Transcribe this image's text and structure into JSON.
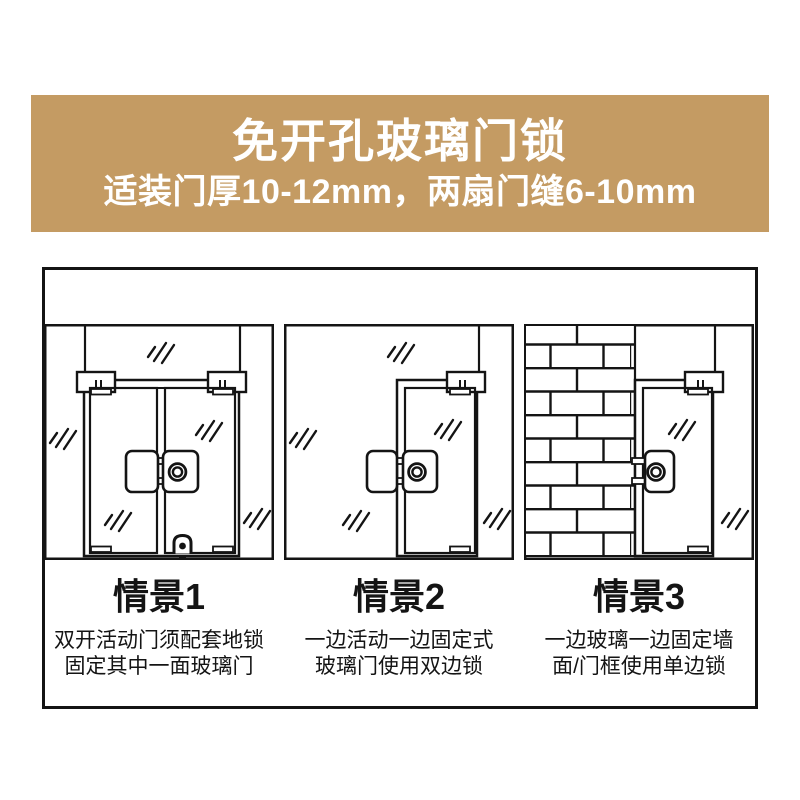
{
  "banner": {
    "title": "免开孔玻璃门锁",
    "subtitle": "适装门厚10-12mm，两扇门缝6-10mm",
    "background_color": "#C49B63",
    "text_color": "#FFFFFF"
  },
  "diagram": {
    "line_color": "#141414",
    "scenarios": [
      {
        "label": "情景1",
        "desc_line1": "双开活动门须配套地锁",
        "desc_line2": "固定其中一面玻璃门",
        "illustration": "double-swing-glass-doors-with-center-lock-and-floor-lock"
      },
      {
        "label": "情景2",
        "desc_line1": "一边活动一边固定式",
        "desc_line2": "玻璃门使用双边锁",
        "illustration": "active-door-with-fixed-glass-double-sided-lock"
      },
      {
        "label": "情景3",
        "desc_line1": "一边玻璃一边固定墙",
        "desc_line2": "面/门框使用单边锁",
        "illustration": "glass-door-beside-brick-wall-single-sided-lock"
      }
    ]
  }
}
